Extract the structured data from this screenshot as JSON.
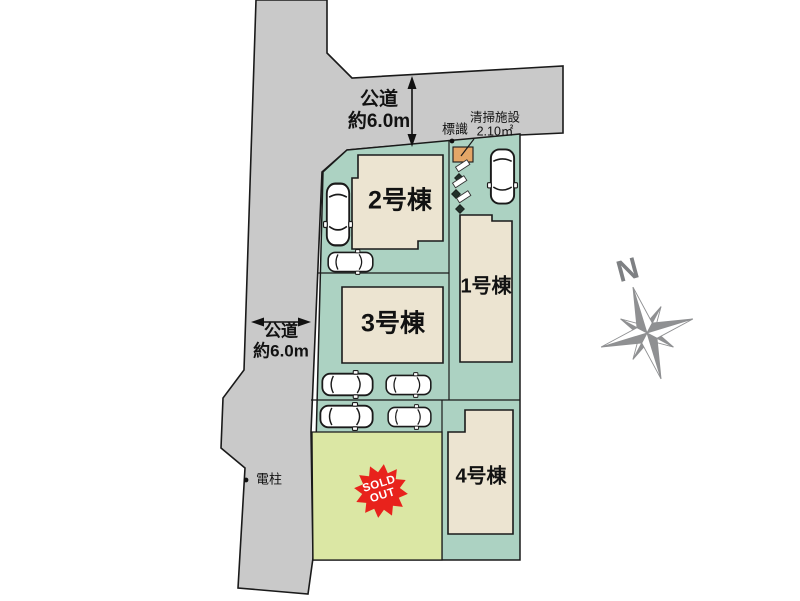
{
  "roads": {
    "top": {
      "line1": "公道",
      "line2": "約6.0m"
    },
    "left": {
      "line1": "公道",
      "line2": "約6.0m"
    }
  },
  "buildings": [
    {
      "id": "1",
      "label": "1号棟"
    },
    {
      "id": "2",
      "label": "2号棟"
    },
    {
      "id": "3",
      "label": "3号棟"
    },
    {
      "id": "4",
      "label": "4号棟"
    }
  ],
  "annotations": {
    "sign": "標識",
    "cleaning_facility_name": "清掃施設",
    "cleaning_facility_area": "2.10㎡",
    "utility_pole": "電柱"
  },
  "sold_badge": {
    "line1": "SOLD",
    "line2": "OUT"
  },
  "compass": {
    "north": "N"
  },
  "colors": {
    "road_gray": "#c9c9c9",
    "lot_teal": "#acd2c2",
    "sold_lot_green": "#dbe7a4",
    "building_beige": "#ece4d1",
    "facility_orange": "#e4a667",
    "sold_badge_red": "#e8221c",
    "compass_gray": "#8f9092",
    "outline_black": "#1a1a1a"
  },
  "icons": [
    "car-icon",
    "compass-rose-icon",
    "diamond-utility-marker-icon",
    "sold-out-starburst-icon",
    "dimension-arrow-icon",
    "point-dot-icon"
  ]
}
